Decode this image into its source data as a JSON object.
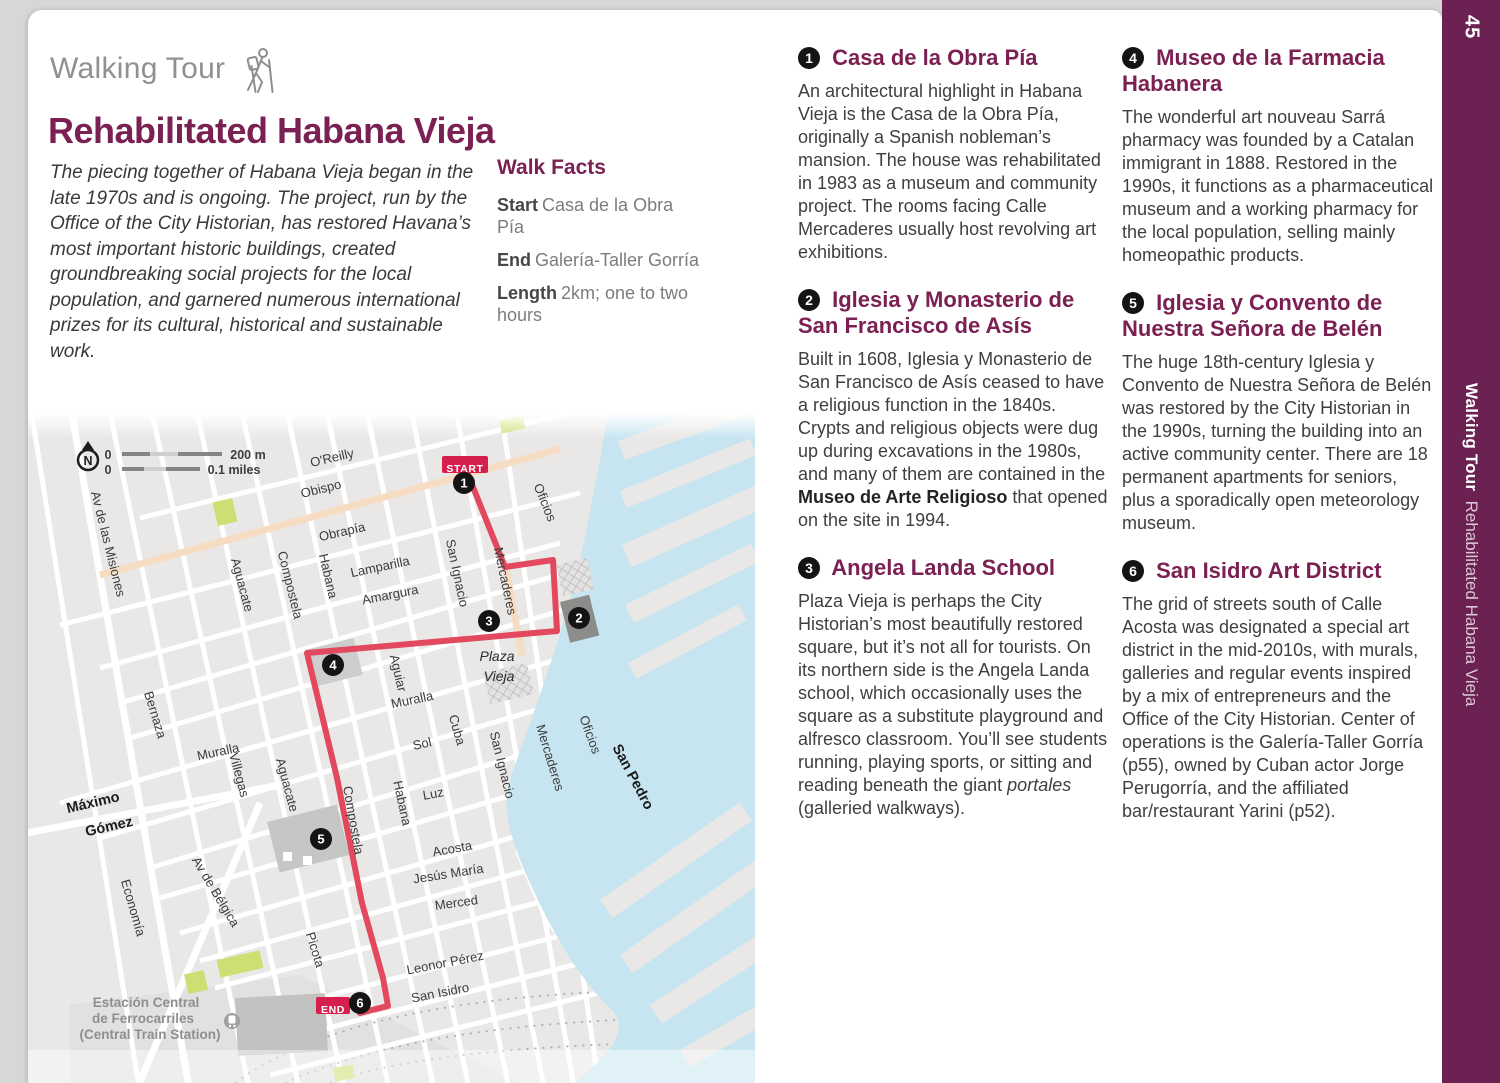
{
  "page": {
    "number": "45"
  },
  "sidebar": {
    "page_number": "45",
    "bold": "Walking Tour",
    "regular": "Rehabilitated Habana Vieja",
    "color": "#6b2152"
  },
  "header": {
    "eyebrow": "Walking Tour",
    "hiker_icon": "hiker-icon",
    "title": "Rehabilitated Habana Vieja",
    "intro": "The piecing together of Habana Vieja began in the late 1970s and is ongoing. The project, run by the Office of the City Historian, has restored Havana’s most important historic buildings, created groundbreaking social projects for the local population, and garnered numerous international prizes for its cultural, historical and sustainable work."
  },
  "walk_facts": {
    "title": "Walk Facts",
    "facts": [
      {
        "label": "Start",
        "value": "Casa de la Obra Pía"
      },
      {
        "label": "End",
        "value": "Galería-Taller Gorría"
      },
      {
        "label": "Length",
        "value": "2km; one to two hours"
      }
    ]
  },
  "sections": [
    {
      "number": "1",
      "column": 1,
      "title": "Casa de la Obra Pía",
      "body": [
        {
          "t": "An architectural highlight in Habana Vieja is the Casa de la Obra Pía, originally a Spanish nobleman’s mansion. The house was rehabilitated in 1983 as a museum and community project. The rooms facing Calle Mercaderes usually host revolving art exhibitions."
        }
      ]
    },
    {
      "number": "2",
      "column": 1,
      "title": "Iglesia y Monasterio de San Francisco de Asís",
      "body": [
        {
          "t": "Built in 1608, Iglesia y Monasterio de San Francisco de Asís ceased to have a religious function in the 1840s. Crypts and religious objects were dug up during excavations in the 1980s, and many of them are contained in the "
        },
        {
          "t": "Museo de Arte Religioso",
          "b": true
        },
        {
          "t": " that opened on the site in 1994."
        }
      ]
    },
    {
      "number": "3",
      "column": 1,
      "title": "Angela Landa School",
      "body": [
        {
          "t": "Plaza Vieja is perhaps the City Historian’s most beautifully restored square, but it’s not all for tourists. On its northern side is the Angela Landa school, which occasionally uses the square as a substitute playground and alfresco classroom. You’ll see students running, playing sports, or sitting and reading beneath the giant "
        },
        {
          "t": "portales",
          "i": true
        },
        {
          "t": " (galleried walkways)."
        }
      ]
    },
    {
      "number": "4",
      "column": 2,
      "title": "Museo de la Farmacia Habanera",
      "body": [
        {
          "t": "The wonderful art nouveau Sarrá pharmacy was founded by a Catalan immigrant in 1888. Restored in the 1990s, it functions as a pharmaceutical museum and a working pharmacy for the local population, selling mainly homeopathic products."
        }
      ]
    },
    {
      "number": "5",
      "column": 2,
      "title": "Iglesia y Convento de Nuestra Señora de Belén",
      "body": [
        {
          "t": "The huge 18th-century Iglesia y Convento de Nuestra Señora de Belén was restored by the City Historian in the 1990s, turning the building into an active community center. There are 18 permanent apartments for seniors, plus a sporadically open meteorology museum."
        }
      ]
    },
    {
      "number": "6",
      "column": 2,
      "title": "San Isidro Art District",
      "body": [
        {
          "t": "The grid of streets south of Calle Acosta was designated a special art district in the mid-2010s, with murals, galleries and regular events inspired by a mix of entrepreneurs and the Office of the City Historian. Center of operations is the Galería-Taller Gorría (p55), owned by Cuban actor Jorge Perugorría, and the affiliated bar/restaurant Yarini (p52)."
        }
      ]
    }
  ],
  "map": {
    "colors": {
      "water": "#c7e5f1",
      "land": "#e9e8e6",
      "park": "#cede72",
      "route": "#e2495f",
      "badge": "#d61f4c",
      "pedestrian_street": "#f6dcc3",
      "marker": "#141414"
    },
    "route_points": "467,472 505,567 553,560 557,631 307,653 337,778 362,903 383,978 388,1006 360,1013",
    "markers": [
      {
        "n": "1",
        "x": 464,
        "y": 483
      },
      {
        "n": "2",
        "x": 579,
        "y": 618
      },
      {
        "n": "3",
        "x": 489,
        "y": 621
      },
      {
        "n": "4",
        "x": 333,
        "y": 665
      },
      {
        "n": "5",
        "x": 321,
        "y": 839
      },
      {
        "n": "6",
        "x": 360,
        "y": 1003
      }
    ],
    "badges": [
      {
        "label": "START",
        "x": 442,
        "y": 456,
        "w": 46,
        "h": 17,
        "tx": 465,
        "ty": 468.5
      },
      {
        "label": "END",
        "x": 316,
        "y": 997,
        "w": 34,
        "h": 17,
        "tx": 333,
        "ty": 1009.5
      }
    ],
    "labels": [
      {
        "t": "N",
        "x": 88,
        "y": 465,
        "r": 0,
        "c": "nb"
      },
      {
        "t": "0",
        "x": 108,
        "y": 459,
        "r": 0,
        "c": "sc"
      },
      {
        "t": "200 m",
        "x": 248,
        "y": 459,
        "r": 0,
        "c": "sc"
      },
      {
        "t": "0",
        "x": 108,
        "y": 474,
        "r": 0,
        "c": "sc"
      },
      {
        "t": "0.1 miles",
        "x": 234,
        "y": 474,
        "r": 0,
        "c": "sc"
      },
      {
        "t": "O'Reilly",
        "x": 333,
        "y": 462,
        "r": -13,
        "c": "st"
      },
      {
        "t": "Obispo",
        "x": 322,
        "y": 493,
        "r": -14,
        "c": "st"
      },
      {
        "t": "Obrapía",
        "x": 343,
        "y": 536,
        "r": -13,
        "c": "st"
      },
      {
        "t": "Lamparilla",
        "x": 381,
        "y": 571,
        "r": -12,
        "c": "st"
      },
      {
        "t": "Amargura",
        "x": 391,
        "y": 599,
        "r": -11,
        "c": "st"
      },
      {
        "t": "Av de las Misiones",
        "x": 104,
        "y": 545,
        "r": 76,
        "c": "st"
      },
      {
        "t": "Aguacate",
        "x": 238,
        "y": 586,
        "r": 75,
        "c": "st"
      },
      {
        "t": "Compostela",
        "x": 286,
        "y": 586,
        "r": 76,
        "c": "st"
      },
      {
        "t": "Habana",
        "x": 324,
        "y": 577,
        "r": 77,
        "c": "st"
      },
      {
        "t": "San Ignacio",
        "x": 453,
        "y": 574,
        "r": 78,
        "c": "st"
      },
      {
        "t": "Mercaderes",
        "x": 501,
        "y": 582,
        "r": 78,
        "c": "st"
      },
      {
        "t": "Oficios",
        "x": 541,
        "y": 504,
        "r": 68,
        "c": "st"
      },
      {
        "t": "Oficios",
        "x": 586,
        "y": 736,
        "r": 70,
        "c": "st"
      },
      {
        "t": "Mercaderes",
        "x": 546,
        "y": 759,
        "r": 73,
        "c": "st"
      },
      {
        "t": "San Ignacio",
        "x": 498,
        "y": 766,
        "r": 76,
        "c": "st"
      },
      {
        "t": "Cuba",
        "x": 453,
        "y": 731,
        "r": 74,
        "c": "st"
      },
      {
        "t": "Aguiar",
        "x": 394,
        "y": 674,
        "r": 77,
        "c": "st"
      },
      {
        "t": "Muralla",
        "x": 413,
        "y": 704,
        "r": -12,
        "c": "st"
      },
      {
        "t": "Muralla",
        "x": 219,
        "y": 756,
        "r": -12,
        "c": "st"
      },
      {
        "t": "Sol",
        "x": 423,
        "y": 748,
        "r": -12,
        "c": "st"
      },
      {
        "t": "Luz",
        "x": 434,
        "y": 798,
        "r": -10,
        "c": "st"
      },
      {
        "t": "Habana",
        "x": 398,
        "y": 804,
        "r": 78,
        "c": "st"
      },
      {
        "t": "Compostela",
        "x": 349,
        "y": 821,
        "r": 80,
        "c": "st"
      },
      {
        "t": "Aguacate",
        "x": 283,
        "y": 786,
        "r": 75,
        "c": "st"
      },
      {
        "t": "Villegas",
        "x": 235,
        "y": 776,
        "r": 75,
        "c": "st"
      },
      {
        "t": "Bernaza",
        "x": 151,
        "y": 716,
        "r": 73,
        "c": "st"
      },
      {
        "t": "Acosta",
        "x": 453,
        "y": 853,
        "r": -10,
        "c": "st"
      },
      {
        "t": "Jesús María",
        "x": 449,
        "y": 878,
        "r": -9,
        "c": "st"
      },
      {
        "t": "Merced",
        "x": 457,
        "y": 907,
        "r": -8,
        "c": "st"
      },
      {
        "t": "Leonor Pérez",
        "x": 446,
        "y": 967,
        "r": -11,
        "c": "st"
      },
      {
        "t": "San Isidro",
        "x": 441,
        "y": 997,
        "r": -11,
        "c": "st"
      },
      {
        "t": "Picota",
        "x": 311,
        "y": 951,
        "r": 73,
        "c": "st"
      },
      {
        "t": "Economía",
        "x": 129,
        "y": 909,
        "r": 74,
        "c": "st"
      },
      {
        "t": "Av de Bélgica",
        "x": 212,
        "y": 894,
        "r": 59,
        "c": "st"
      },
      {
        "t": "Máximo",
        "x": 94,
        "y": 807,
        "r": -13,
        "c": "b"
      },
      {
        "t": "Gómez",
        "x": 110,
        "y": 831,
        "r": -13,
        "c": "b"
      },
      {
        "t": "San Pedro",
        "x": 629,
        "y": 779,
        "r": 62,
        "c": "b"
      },
      {
        "t": "Plaza",
        "x": 497,
        "y": 661,
        "r": 0,
        "c": "it"
      },
      {
        "t": "Vieja",
        "x": 499,
        "y": 681,
        "r": 0,
        "c": "it"
      },
      {
        "t": "Estación Central",
        "x": 146,
        "y": 1007,
        "r": 0,
        "c": "stn"
      },
      {
        "t": "de Ferrocarriles",
        "x": 143,
        "y": 1023,
        "r": 0,
        "c": "stn"
      },
      {
        "t": "(Central Train Station)",
        "x": 150,
        "y": 1039,
        "r": 0,
        "c": "stn"
      }
    ]
  }
}
